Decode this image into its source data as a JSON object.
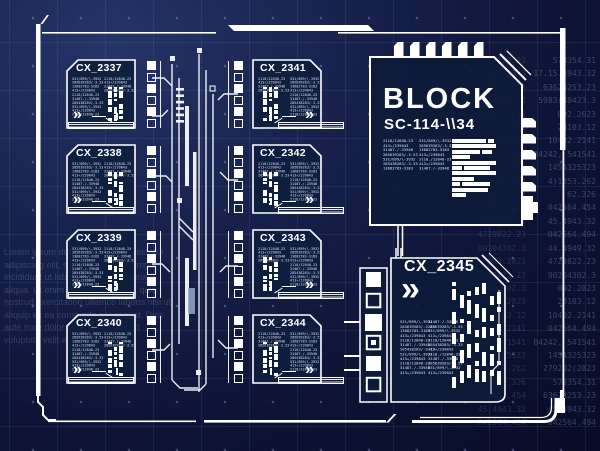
{
  "colors": {
    "background_top": "#243568",
    "background_bottom": "#090c26",
    "panel_fill": "#0e1e3e",
    "line": "#ffffff",
    "grid": "#8caaf0"
  },
  "panels": {
    "chevron_glyph": "»",
    "left": [
      {
        "title": "CX_2337"
      },
      {
        "title": "CX_2338"
      },
      {
        "title": "CX_2339"
      },
      {
        "title": "CX_2340"
      }
    ],
    "right": [
      {
        "title": "CX_2341"
      },
      {
        "title": "CX_2342"
      },
      {
        "title": "CX_2343"
      },
      {
        "title": "CX_2344"
      }
    ]
  },
  "microtext": {
    "long": [
      "531/899/\\-3932",
      "285639283/-3.53",
      "13682783-3183",
      "413+/239843",
      "2118/12848-23",
      "31487./-33948",
      "285438283/-3.33",
      "531/899/\\-3932",
      "413+/239843",
      "2118/12848-23"
    ],
    "short": [
      "2118/12848-23",
      "413+/239843",
      "31487./-33948",
      "285639283/-3.53"
    ]
  },
  "block": {
    "title": "BLOCK",
    "subtitle": "SC-114-\\\\34",
    "text_left": [
      "2118/12848-23",
      "413+/239843",
      "31487./-33948",
      "285639283/-3.53",
      "531/899/\\-3932",
      "285438283/-3.33",
      "13682783-3183"
    ],
    "text_right": [
      "531/849/\\-3932",
      "285639283/-3.33",
      "13682783-3183",
      "413+/239843",
      "2118./12848-23",
      "413+/239843",
      "31487./-33948"
    ],
    "bars": [
      [
        34,
        6
      ],
      [
        44
      ],
      [
        28,
        10
      ],
      [
        18
      ],
      [
        44
      ],
      [
        10,
        26
      ],
      [
        44
      ],
      [
        22
      ],
      [
        8,
        28
      ],
      [
        36
      ],
      [
        14
      ]
    ]
  },
  "cx2345": {
    "title": "CX_2345",
    "chevron_glyph": "»",
    "text_left": [
      "531/899/\\-3932",
      "285639283/-3.53",
      "13682783-3183",
      "413+/239843",
      "2118/12848-23",
      "31487./-33948",
      "285438283/-3.33",
      "531/899/\\-3932",
      "413+/239843",
      "2118/12848-23",
      "31487./-33948",
      "413+/239843"
    ],
    "text_right": [
      "31487./-33948",
      "285639283/-3.53",
      "531/899/\\-3932",
      "413+/239843",
      "2118/12848-23",
      "285438283/-3.33",
      "413+/239843",
      "2118./12848-23",
      "31487./-33948",
      "285639283/-3.53",
      "531/899/\\-3932",
      "413+/239843"
    ]
  },
  "background_text": {
    "lorem": "Lorem ipsum dolor sit amet, consectetur adipiscing elit, sed do eiusmod tempor incididunt ut labore et dolore magna aliqua. Ut enim ad minim veniam, quis nostrud exercitation ullamco laboris nisi ut aliquip ex ea commodo consequat. Duis aute irure dolor in reprehenderit in voluptate velit esse.",
    "numbers_col1": [
      "53624253.23",
      "0423(48423.3",
      "092.2623",
      "23103.12",
      "10402.2141",
      "042, 541541",
      "04.325323",
      "4)1353.262",
      "62.326",
      "042564.454",
      "45.4943.32",
      "042564.494",
      "44.4949.32",
      "4729822.23",
      "90204302.3",
      "092.2823",
      "4729822.23",
      "60004302.3",
      "092.2823",
      "23103.12",
      "10402.2141",
      "042, 541541",
      "04.325323",
      "4)1353.262",
      "62.326",
      "042564.454",
      "45.4943.32",
      "042564.494"
    ],
    "numbers_col2": [
      "578354.31",
      "17.15.4943.32",
      "63624253.23",
      "5983(48423.3",
      "092.2623",
      "23103.12",
      "10402.2141",
      "04242, 541541",
      "145A325323",
      "4)1353.262",
      "62.326",
      "042564.454",
      "45.4943.32",
      "042564.494",
      "44.4949.32",
      "4729822.23",
      "90204302.3",
      "092.2823",
      "23103.12",
      "10402.2141",
      "042564.494",
      "04242, 541541",
      "145A325323",
      "279202(2823",
      "578354.31",
      "63624253.23",
      "45.4943.32",
      "042564.494"
    ]
  }
}
